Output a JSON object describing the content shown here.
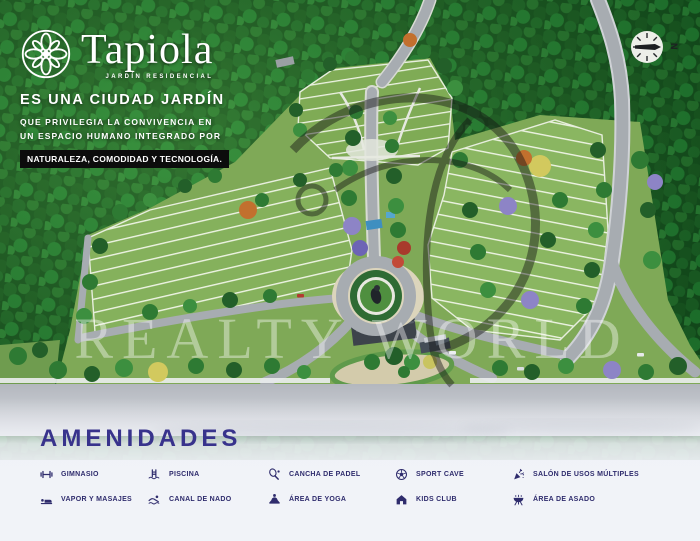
{
  "brand": {
    "name": "Tapiola",
    "tagline": "JARDÍN RESIDENCIAL"
  },
  "hero": {
    "headline": "ES UNA CIUDAD JARDÍN",
    "sub_line1": "QUE PRIVILEGIA LA CONVIVENCIA EN",
    "sub_line2": "UN ESPACIO HUMANO INTEGRADO POR",
    "badge": "NATURALEZA, COMODIDAD Y TECNOLOGÍA."
  },
  "compass": {
    "label": "N"
  },
  "watermark": {
    "text": "REALTY WORLD"
  },
  "amenities": {
    "title": "AMENIDADES",
    "items": [
      {
        "icon": "gym-icon",
        "label": "GIMNASIO"
      },
      {
        "icon": "massage-icon",
        "label": "VAPOR Y MASAJES"
      },
      {
        "icon": "pool-ladder-icon",
        "label": "PISCINA"
      },
      {
        "icon": "swimmer-icon",
        "label": "CANAL DE NADO"
      },
      {
        "icon": "padel-racket-icon",
        "label": "CANCHA DE PADEL"
      },
      {
        "icon": "yoga-icon",
        "label": "ÁREA DE YOGA"
      },
      {
        "icon": "soccer-ball-icon",
        "label": "SPORT CAVE"
      },
      {
        "icon": "house-icon",
        "label": "KIDS CLUB"
      },
      {
        "icon": "party-popper-icon",
        "label": "SALÓN DE USOS MÚLTIPLES"
      },
      {
        "icon": "grill-icon",
        "label": "ÁREA DE ASADO"
      }
    ]
  },
  "colors": {
    "accent_navy": "#38338c",
    "badge_black": "#0c0c0c",
    "forest_green": "#1d6427",
    "lot_green": "#85b15c",
    "road_gray": "#a7acb1",
    "panel_bg": "#f1f3f8"
  }
}
